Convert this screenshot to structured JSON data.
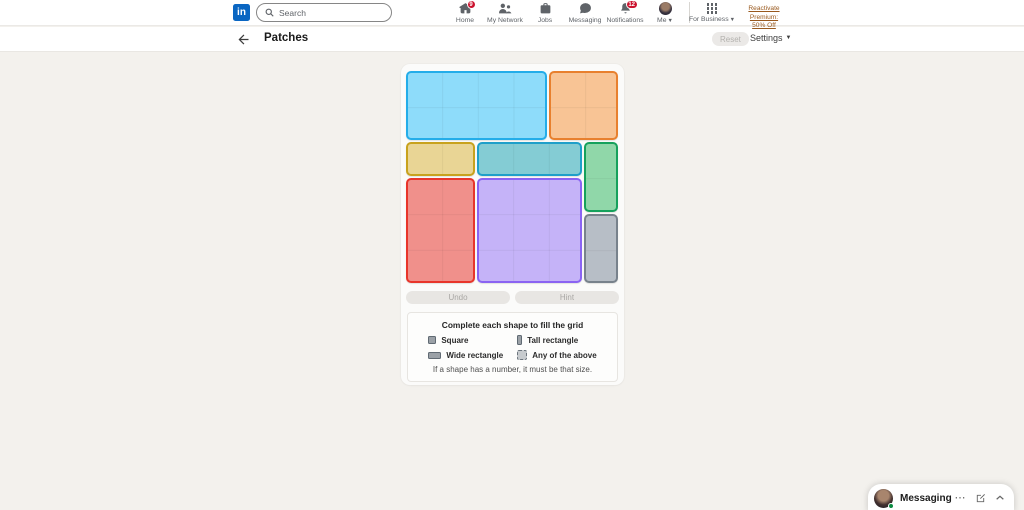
{
  "nav": {
    "logo_text": "in",
    "search": {
      "placeholder": "Search"
    },
    "items": [
      {
        "label": "Home",
        "icon": "home-icon",
        "badge": "9"
      },
      {
        "label": "My Network",
        "icon": "my-network-icon",
        "badge": ""
      },
      {
        "label": "Jobs",
        "icon": "briefcase-icon",
        "badge": ""
      },
      {
        "label": "Messaging",
        "icon": "chat-bubble-icon",
        "badge": ""
      },
      {
        "label": "Notifications",
        "icon": "bell-icon",
        "badge": "12"
      },
      {
        "label": "Me",
        "icon": "avatar",
        "badge": ""
      }
    ],
    "for_business": {
      "label": "For Business"
    },
    "premium": {
      "line1": "Reactivate Premium:",
      "line2": "50% Off"
    }
  },
  "header": {
    "title": "Patches",
    "reset_label": "Reset",
    "settings_label": "Settings"
  },
  "board": {
    "cols": 6,
    "rows": 6,
    "patches": [
      {
        "name": "blue",
        "col": 0,
        "row": 0,
        "w": 4,
        "h": 2,
        "fill": "#8edcfa",
        "border": "#24ade9"
      },
      {
        "name": "orange",
        "col": 4,
        "row": 0,
        "w": 2,
        "h": 2,
        "fill": "#f8c495",
        "border": "#e8802e"
      },
      {
        "name": "tan",
        "col": 0,
        "row": 2,
        "w": 2,
        "h": 1,
        "fill": "#e9d595",
        "border": "#c8a21d"
      },
      {
        "name": "teal",
        "col": 2,
        "row": 2,
        "w": 3,
        "h": 1,
        "fill": "#84ccd4",
        "border": "#1f9fc9"
      },
      {
        "name": "green",
        "col": 5,
        "row": 2,
        "w": 1,
        "h": 2,
        "fill": "#90d7a9",
        "border": "#16a15c"
      },
      {
        "name": "red",
        "col": 0,
        "row": 3,
        "w": 2,
        "h": 3,
        "fill": "#f0908b",
        "border": "#e8352b"
      },
      {
        "name": "purple",
        "col": 2,
        "row": 3,
        "w": 3,
        "h": 3,
        "fill": "#c5b3f8",
        "border": "#8a63f2"
      },
      {
        "name": "gray",
        "col": 5,
        "row": 4,
        "w": 1,
        "h": 2,
        "fill": "#b7bec6",
        "border": "#78828c"
      }
    ]
  },
  "controls": {
    "undo_label": "Undo",
    "hint_label": "Hint"
  },
  "legend": {
    "title": "Complete each shape to fill the grid",
    "items": [
      {
        "label": "Square",
        "icon": "square-icon"
      },
      {
        "label": "Tall rectangle",
        "icon": "tall-rectangle-icon"
      },
      {
        "label": "Wide rectangle",
        "icon": "wide-rectangle-icon"
      },
      {
        "label": "Any of the above",
        "icon": "any-shape-icon"
      }
    ],
    "caption": "If a shape has a number, it must be that size."
  },
  "dock": {
    "label": "Messaging"
  }
}
